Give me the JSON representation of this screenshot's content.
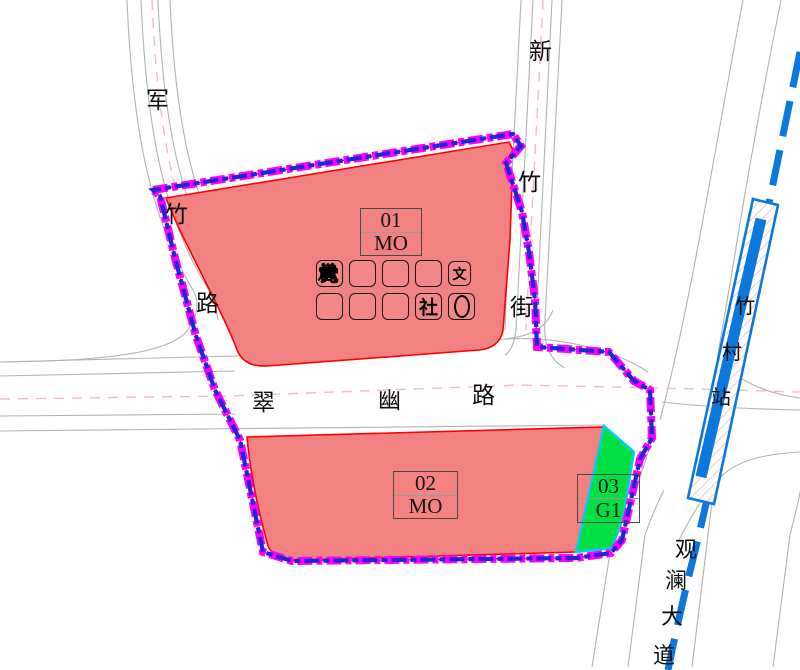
{
  "roads": {
    "junzhu": {
      "name": "军竹路",
      "chars": [
        "军",
        "竹",
        "路"
      ]
    },
    "xinzhu": {
      "name": "新竹街",
      "chars": [
        "新",
        "竹",
        "街"
      ]
    },
    "cuiyou": {
      "name": "翠幽路",
      "chars": [
        "翠",
        "幽",
        "路"
      ]
    },
    "guanlan": {
      "name": "观澜大道",
      "chars": [
        "观",
        "澜",
        "大",
        "道"
      ]
    }
  },
  "station": {
    "name": "竹村站",
    "chars": [
      "竹",
      "村",
      "站"
    ]
  },
  "parcels": [
    {
      "number": "01",
      "code": "MO",
      "fill": "#F28181"
    },
    {
      "number": "02",
      "code": "MO",
      "fill": "#F28181"
    },
    {
      "number": "03",
      "code": "G1",
      "fill": "#00E042"
    }
  ],
  "facility_icons": {
    "row1": [
      {
        "name": "party-building-icon",
        "glyph": "党"
      },
      {
        "name": "bus-shelter-icon"
      },
      {
        "name": "boat-dock-icon"
      },
      {
        "name": "recycling-station-icon"
      },
      {
        "name": "culture-facility-icon",
        "glyph": "文"
      }
    ],
    "row2": [
      {
        "name": "pump-station-icon"
      },
      {
        "name": "public-toilet-icon"
      },
      {
        "name": "substation-icon"
      },
      {
        "name": "community-center-icon",
        "glyph": "社"
      },
      {
        "name": "oval-marker-icon"
      }
    ]
  },
  "colors": {
    "parcel_red_fill": "#F28181",
    "parcel_red_stroke": "#FF0000",
    "parcel_green_fill": "#00E042",
    "parcel_green_stroke": "#00CCF5",
    "boundary_magenta": "#FF00FF",
    "boundary_blue": "#2323DC",
    "metro_blue": "#0B79DC",
    "station_hatch_pink": "#F0B6C4",
    "road_gray": "#B3B3B3",
    "centerline_pink": "#F5BDBD"
  }
}
